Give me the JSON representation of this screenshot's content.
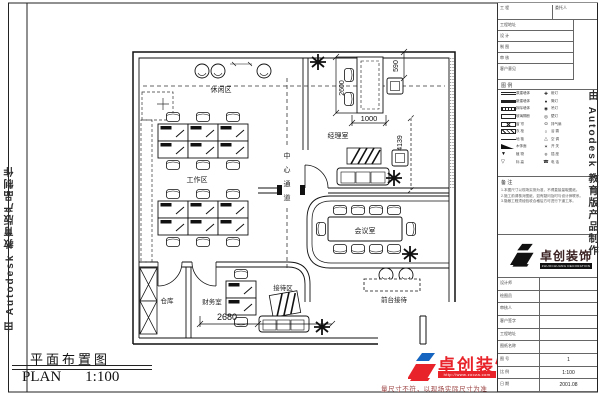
{
  "watermark": {
    "text": "由 Autodesk 教育版产品制作"
  },
  "plan": {
    "rooms": [
      {
        "label": "休闲区"
      },
      {
        "label": "工作区"
      },
      {
        "label": "经理室"
      },
      {
        "label": "会议室"
      },
      {
        "label": "仓库"
      },
      {
        "label": "财务室"
      },
      {
        "label": "接待区"
      },
      {
        "label": "前台接待"
      }
    ],
    "aisle_chars": [
      "中",
      "心",
      "通",
      "道"
    ],
    "dims": [
      "2600",
      "1000",
      "590",
      "4139",
      "2680"
    ]
  },
  "footer": {
    "title_cn": "平面布置图",
    "plan_label": "PLAN",
    "scale": "1:100",
    "brand": "卓创装饰",
    "brand_url": "http://www.zocza.com",
    "disclaimer": "量尺寸不符，以现场实际尺寸为准"
  },
  "titleblock": {
    "top_rows": [
      {
        "l": "工 程",
        "r": "委托人"
      },
      {
        "l": "工程地址"
      },
      {
        "l": "设 计"
      },
      {
        "l": "制 图"
      },
      {
        "l": "审 核"
      },
      {
        "l": "客户意见"
      }
    ],
    "legend_title": "图 例",
    "legend": [
      {
        "a": "原建墙体",
        "b": "射灯"
      },
      {
        "a": "新建墙体",
        "b": "筒灯"
      },
      {
        "a": "拆除墙体",
        "b": "吊灯"
      },
      {
        "a": "玻璃隔断",
        "b": "壁灯"
      },
      {
        "a": "窗 帘",
        "b": "排气扇"
      },
      {
        "a": "衣 柜",
        "b": "浴 霸"
      },
      {
        "a": "地 毯",
        "b": "空 调"
      },
      {
        "a": "木饰面",
        "b": "开 关"
      },
      {
        "a": "植 物",
        "b": "插 座"
      },
      {
        "a": "标 高",
        "b": "电 话"
      }
    ],
    "notes_title": "备 注",
    "notes": [
      "1.本图尺寸以现场实测为准，不得直接量取图纸。",
      "2.施工前请核对图纸，如有疑问及时与设计师联系。",
      "3.隐蔽工程须经验收合格后方可进行下道工序。"
    ],
    "logo_text": "卓创装饰",
    "logo_sub": "ZHUOCHUANG DECORATION",
    "bottom_rows": [
      {
        "l": "设计师",
        "v": ""
      },
      {
        "l": "绘图员",
        "v": ""
      },
      {
        "l": "审核人",
        "v": ""
      },
      {
        "l": "客户签字",
        "v": ""
      },
      {
        "l": "工程地址",
        "v": ""
      },
      {
        "l": "图纸名称",
        "v": ""
      },
      {
        "l": "图 号",
        "v": "1"
      },
      {
        "l": "比 例",
        "v": "1:100"
      },
      {
        "l": "日 期",
        "v": "2001.08"
      }
    ]
  }
}
